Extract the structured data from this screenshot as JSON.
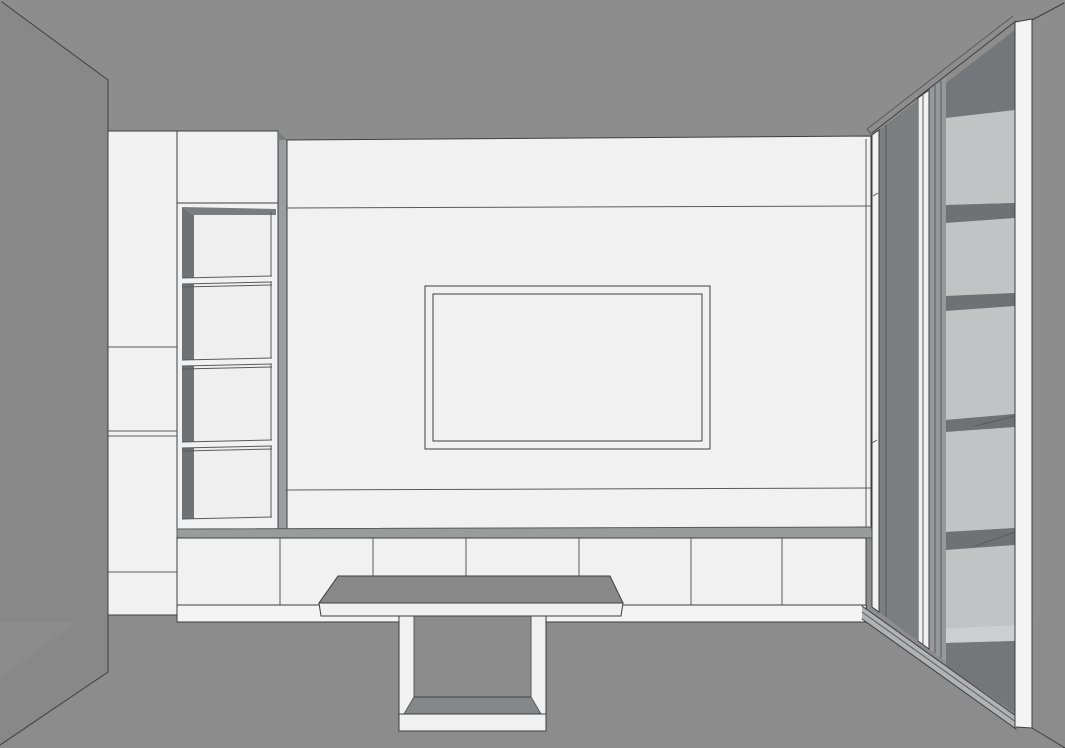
{
  "scene": {
    "title": "Perspective 3D render of a living-room media wall",
    "view": "one-point perspective, facing TV wall",
    "objects": {
      "left_wall": "plain gray wall angled toward viewer",
      "tall_cabinet_left": {
        "description": "white full-height cabinet with flat door fronts",
        "sections": 4
      },
      "upper_cabinet_box": {
        "description": "white wall cabinet above open shelf column",
        "sections": 1
      },
      "open_shelf_column": {
        "description": "open shelving tower, white interior, dark side panels",
        "compartments": 4,
        "shelves": 3
      },
      "tv_wall_panel": {
        "description": "large white back panel with recessed rectangular TV frame",
        "frame_rectangles": 2,
        "horizontal_reveals": 2
      },
      "base_cabinet_row": {
        "description": "low white base cabinets under TV panel",
        "door_fronts": 7,
        "plinth": true
      },
      "table": {
        "description": "console/coffee table with gray top, white edge and white loop leg",
        "legs": "closed rectangular loop"
      },
      "glass_display_cabinet_right": {
        "description": "tall display cabinet with sliding glass doors seen at an angle",
        "visible_compartments": 5,
        "sliding_doors": 2,
        "floor_track": true
      },
      "right_side_board": "white vertical end panel at far right",
      "right_wall": "gray return wall at far right"
    }
  },
  "colors": {
    "wall": "#8d8d8d",
    "wall_left": "#888889",
    "floor": "#8c8c8c",
    "outline": "#3e3e3e",
    "outline_soft": "#5a5a5a",
    "furniture_white": "#f1f1f1",
    "plinth_white": "#f3f3f3",
    "shelf_interior_white": "#efefef",
    "side_panel_dark": "#6f7173",
    "top_shadow": "#7a7c7e",
    "recess_gray": "#9b9d9e",
    "counter_gray": "#9a9c9c",
    "glass_gray": "#7b7e7f",
    "far_door_gray": "#96999a",
    "interior_light": "#c1c4c5",
    "interior_dark": "#74777a",
    "shelf_band_dark": "#6f7274",
    "interior_kick_light": "#ccced0",
    "track_gray": "#b0b2b3",
    "table_top_gray": "#898989",
    "table_inner_face": "#858788"
  }
}
